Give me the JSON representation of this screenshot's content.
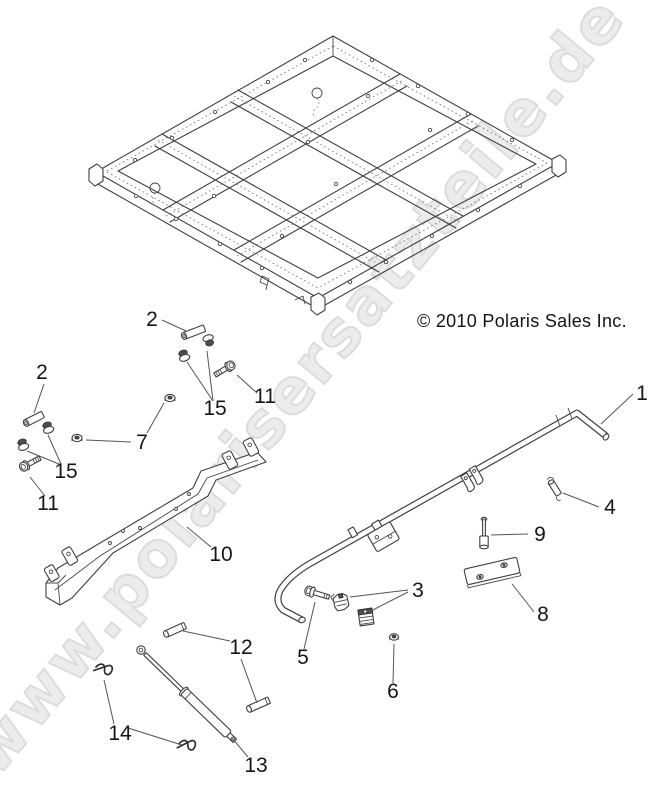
{
  "watermark": {
    "text": "www.polarisersatzteile.de",
    "fill": "#ececec",
    "outline": "#dcdcdc"
  },
  "copyright": {
    "text": "© 2010 Polaris Sales Inc."
  },
  "colors": {
    "line_art": "#3f3f3f",
    "label": "#161616",
    "background": "#ffffff"
  },
  "callouts": {
    "c1": {
      "label": "1"
    },
    "c2_right": {
      "label": "2"
    },
    "c2_left": {
      "label": "2"
    },
    "c3": {
      "label": "3"
    },
    "c4": {
      "label": "4"
    },
    "c5": {
      "label": "5"
    },
    "c6": {
      "label": "6"
    },
    "c7": {
      "label": "7"
    },
    "c8": {
      "label": "8"
    },
    "c9": {
      "label": "9"
    },
    "c10": {
      "label": "10"
    },
    "c11_right": {
      "label": "11"
    },
    "c11_left": {
      "label": "11"
    },
    "c12": {
      "label": "12"
    },
    "c13": {
      "label": "13"
    },
    "c14": {
      "label": "14"
    },
    "c15_right": {
      "label": "15"
    },
    "c15_left": {
      "label": "15"
    }
  }
}
